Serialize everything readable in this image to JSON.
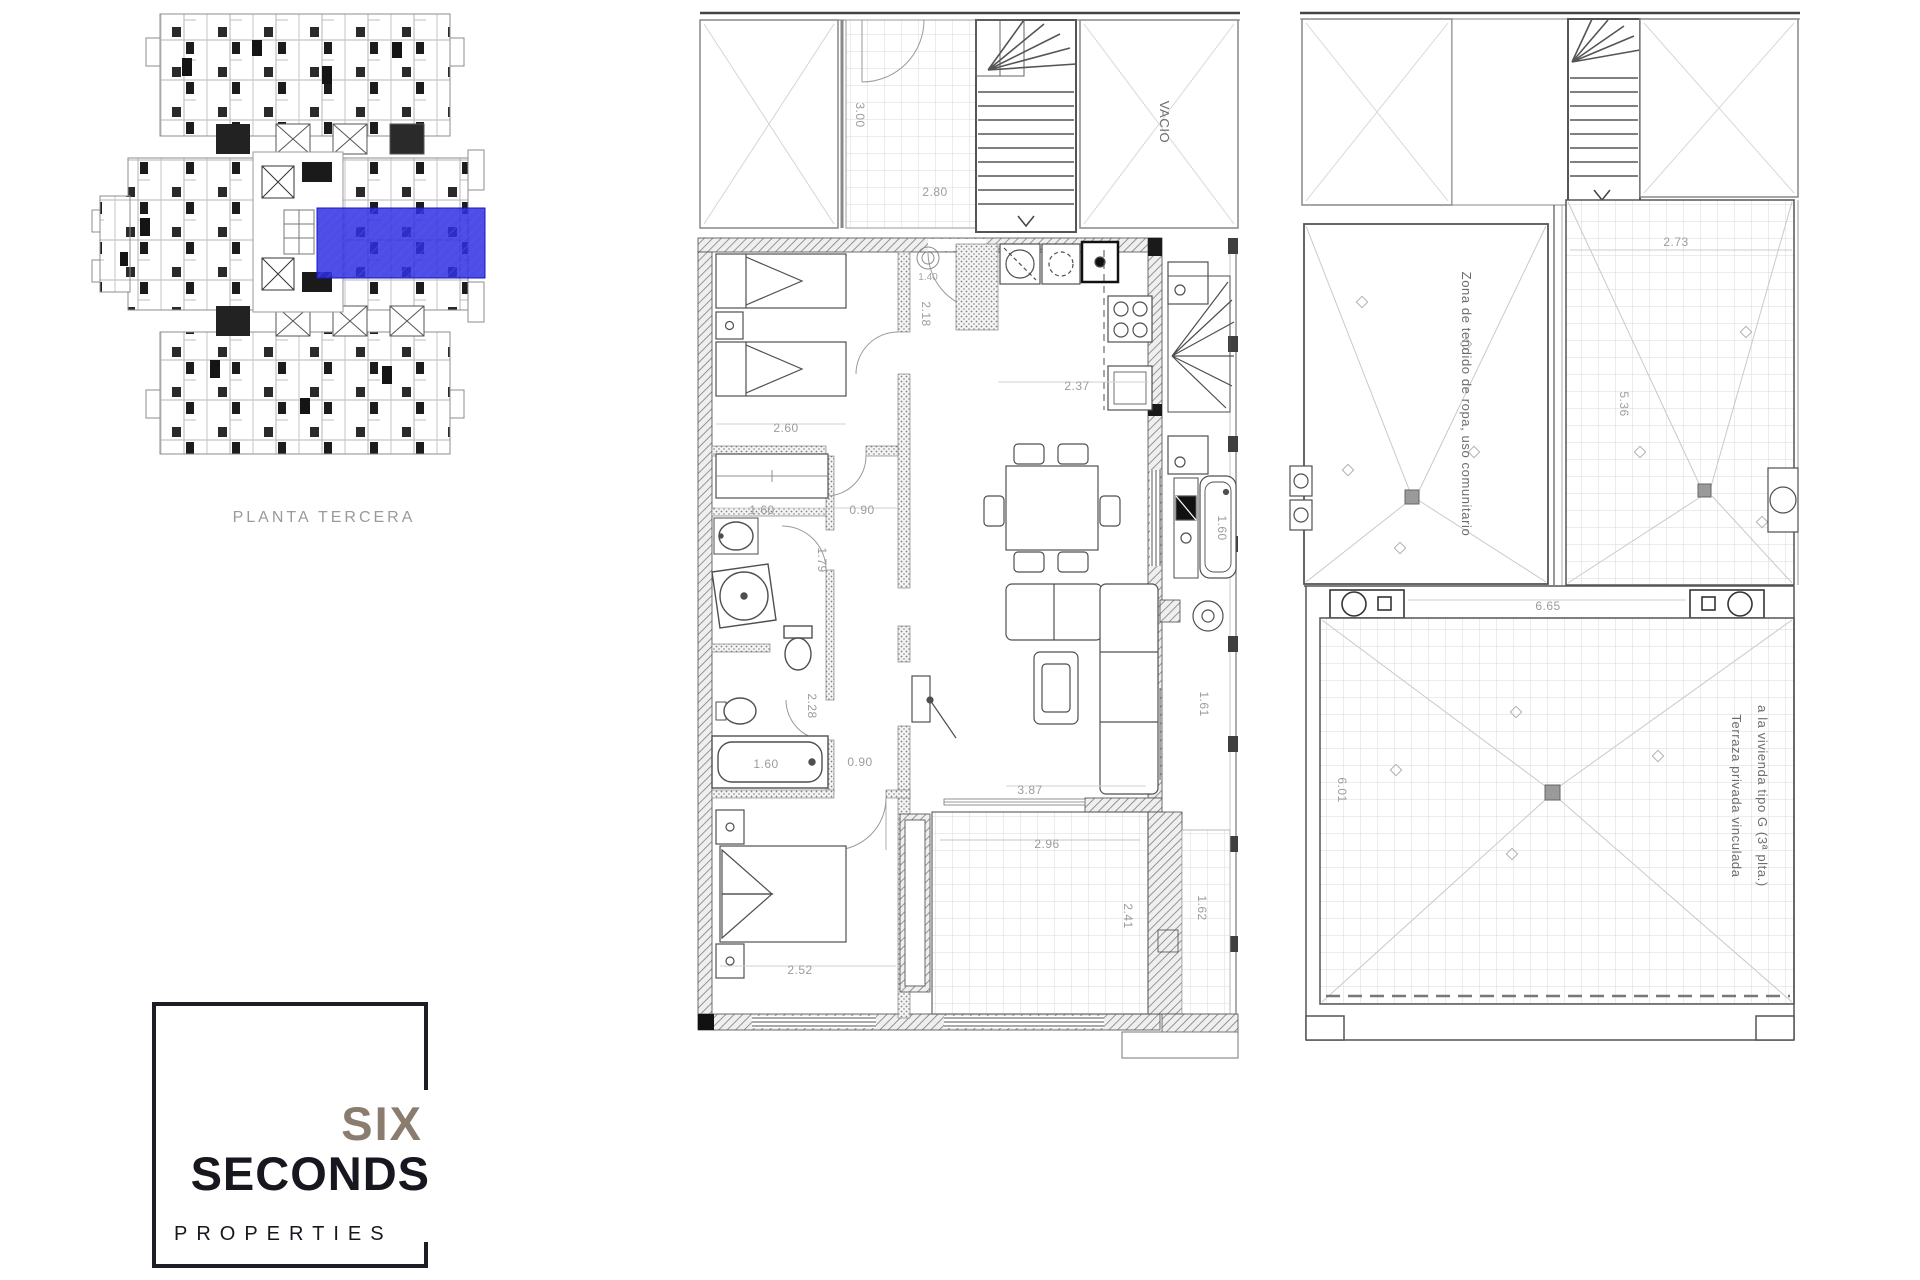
{
  "overview": {
    "caption": "PLANTA TERCERA",
    "highlight_color": "#2f2fe2",
    "highlight_border": "#1818c0"
  },
  "apartment": {
    "void_label": "VACIO",
    "dims": {
      "lobby_depth": "3.00",
      "lobby_width": "2.80",
      "hall_fixture": "1.40",
      "bed1_door": "2.18",
      "bed1_width": "2.60",
      "wardrobe_width": "1.60",
      "hall_width": "0.90",
      "bath1_depth": "1.79",
      "bath2_depth": "2.28",
      "bathtub_length": "1.60",
      "bath_hall_width": "0.90",
      "bed2_width": "2.52",
      "kitchen_width": "2.37",
      "living_length": "3.87",
      "terrace_width": "2.96",
      "terrace_depth": "2.41",
      "gallery_sink": "1.60",
      "gallery_mid": "1.61",
      "gallery_low": "1.62"
    }
  },
  "roof": {
    "laundry_label": "Zona de tendido de ropa, uso comunitario",
    "terrace_label_line1": "Terraza privada vinculada",
    "terrace_label_line2": "a la vivienda tipo G (3ª plta.)",
    "dims": {
      "upper_terrace_width": "2.73",
      "upper_terrace_depth": "5.36",
      "terrace_width": "6.65",
      "terrace_depth": "6.01"
    }
  },
  "logo": {
    "word1": "SIX",
    "word2": "SECONDS",
    "word3": "PROPERTIES",
    "accent_color": "#8a7d70",
    "ink_color": "#17171f"
  }
}
